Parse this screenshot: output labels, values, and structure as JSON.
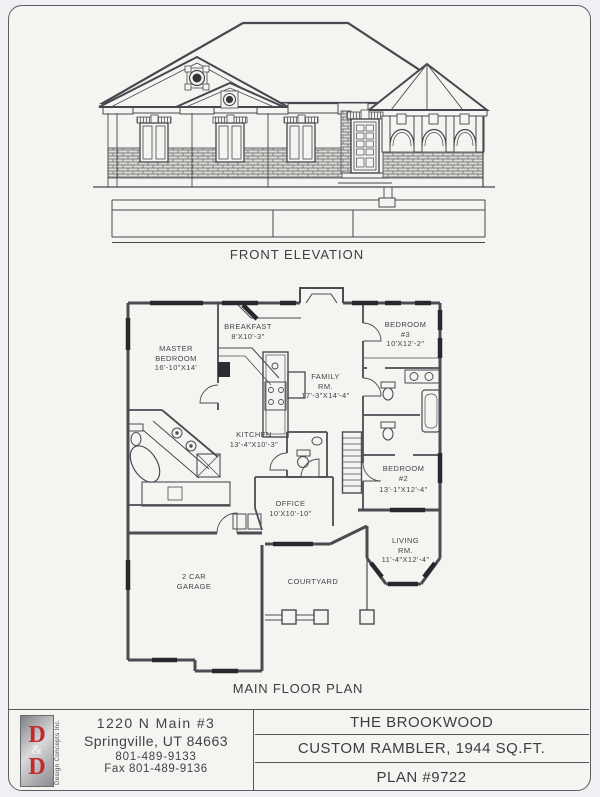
{
  "elevation": {
    "caption": "FRONT ELEVATION"
  },
  "floor_plan": {
    "caption": "MAIN FLOOR PLAN",
    "rooms": {
      "master": {
        "l1": "MASTER",
        "l2": "BEDROOM",
        "l3": "16'-10\"X14'"
      },
      "breakfast": {
        "l1": "BREAKFAST",
        "l2": "8'X10'-3\""
      },
      "family": {
        "l1": "FAMILY",
        "l2": "RM.",
        "l3": "17'-3\"X14'-4\""
      },
      "kitchen": {
        "l1": "KITCHEN",
        "l2": "13'-4\"X10'-3\""
      },
      "bedroom3": {
        "l1": "BEDROOM",
        "l2": "#3",
        "l3": "10'X12'-2\""
      },
      "bedroom2": {
        "l1": "BEDROOM",
        "l2": "#2",
        "l3": "13'-1\"X12'-4\""
      },
      "living": {
        "l1": "LIVING",
        "l2": "RM.",
        "l3": "11'-4\"X12'-4\""
      },
      "office": {
        "l1": "OFFICE",
        "l2": "10'X10'-10\""
      },
      "garage": {
        "l1": "2 CAR",
        "l2": "GARAGE"
      },
      "courtyard": {
        "l1": "COURTYARD"
      }
    }
  },
  "footer": {
    "logo": {
      "letter_top": "D",
      "amp": "&",
      "letter_bottom": "D",
      "vertical_text": "Design Concepts Inc."
    },
    "address_line1": "1220 N Main #3",
    "address_line2": "Springville, UT 84663",
    "phone": "801-489-9133",
    "fax": "Fax 801-489-9136",
    "title": "THE BROOKWOOD",
    "subtitle": "CUSTOM RAMBLER, 1944 SQ.FT.",
    "plan_number": "PLAN #9722"
  },
  "colors": {
    "logo_red": "#c32a2c",
    "line_color": "#4a4c54",
    "paper": "#f4f4f0",
    "window_bar": "#26282e"
  }
}
